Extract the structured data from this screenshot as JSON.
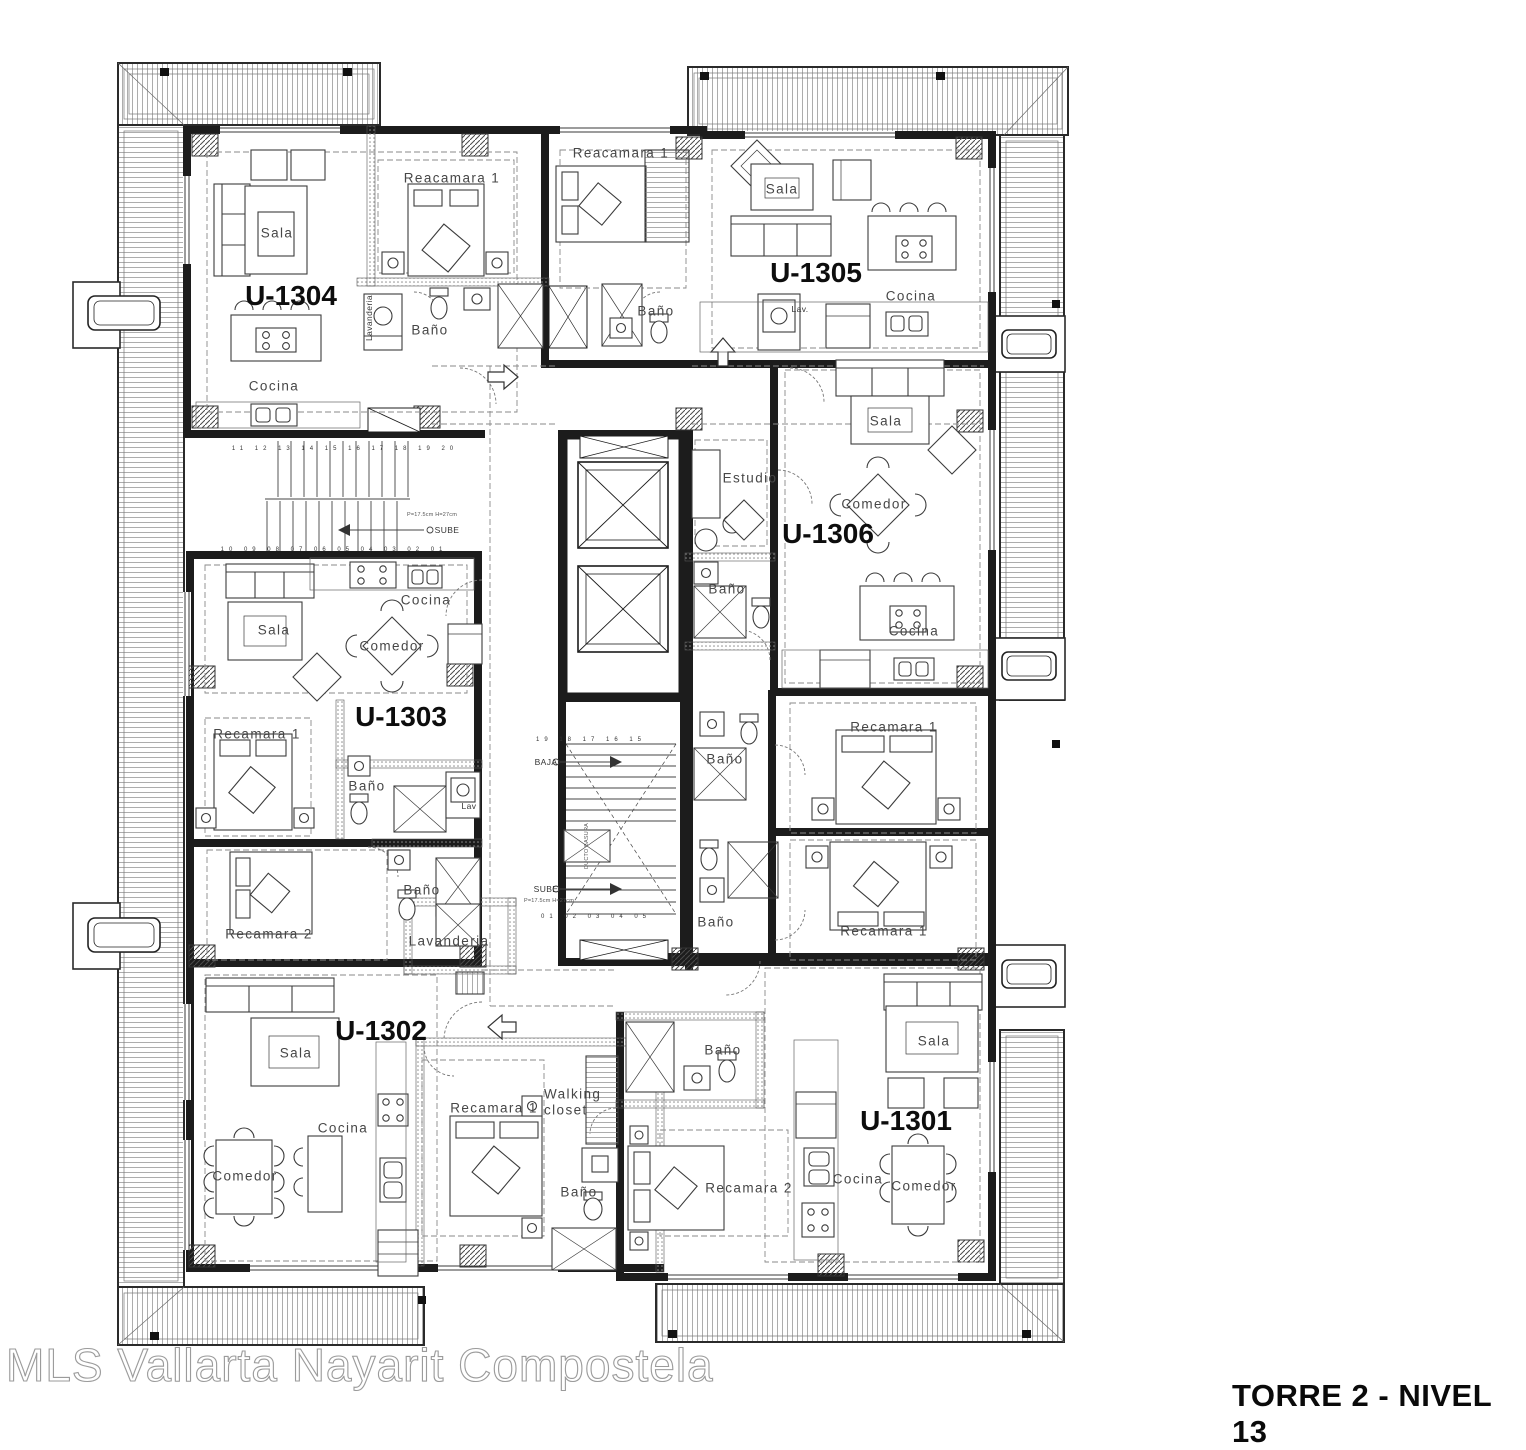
{
  "header": {
    "title": "TORRE 2 - NIVEL 13",
    "watermark": "MLS Vallarta Nayarit Compostela"
  },
  "units": [
    {
      "id": "U-1301",
      "rooms": [
        "Sala",
        "Comedor",
        "Cocina",
        "Recamara 1",
        "Recamara 2",
        "Baño"
      ]
    },
    {
      "id": "U-1302",
      "rooms": [
        "Sala",
        "Comedor",
        "Cocina",
        "Recamara 1",
        "Recamara 2",
        "Walking closet",
        "Baño",
        "Lavanderia"
      ]
    },
    {
      "id": "U-1303",
      "rooms": [
        "Sala",
        "Comedor",
        "Cocina",
        "Recamara 1",
        "Recamara 2",
        "Baño",
        "Lav"
      ]
    },
    {
      "id": "U-1304",
      "rooms": [
        "Sala",
        "Cocina",
        "Reacamara 1",
        "Baño",
        "Lavanderia"
      ]
    },
    {
      "id": "U-1305",
      "rooms": [
        "Sala",
        "Cocina",
        "Reacamara 1",
        "Baño",
        "Lav."
      ]
    },
    {
      "id": "U-1306",
      "rooms": [
        "Sala",
        "Comedor",
        "Cocina",
        "Estudio",
        "Recamara 1",
        "Baño"
      ]
    }
  ],
  "core": {
    "stair_labels": [
      "SUBE",
      "BAJA"
    ],
    "shaft_label": "DUCTO BASURA",
    "stair_note": "P=17.5cm  H=27cm"
  },
  "labels": [
    {
      "t": "U-1304",
      "x": 291,
      "y": 296,
      "c": "u",
      "n": "unit-label-u1304"
    },
    {
      "t": "U-1305",
      "x": 816,
      "y": 273,
      "c": "u",
      "n": "unit-label-u1305"
    },
    {
      "t": "U-1306",
      "x": 828,
      "y": 534,
      "c": "u",
      "n": "unit-label-u1306"
    },
    {
      "t": "U-1303",
      "x": 401,
      "y": 717,
      "c": "u",
      "n": "unit-label-u1303"
    },
    {
      "t": "U-1302",
      "x": 381,
      "y": 1031,
      "c": "u",
      "n": "unit-label-u1302"
    },
    {
      "t": "U-1301",
      "x": 906,
      "y": 1121,
      "c": "u",
      "n": "unit-label-u1301"
    },
    {
      "t": "Sala",
      "x": 277,
      "y": 233
    },
    {
      "t": "Reacamara 1",
      "x": 452,
      "y": 178
    },
    {
      "t": "Baño",
      "x": 430,
      "y": 330
    },
    {
      "t": "Lavanderia",
      "x": 369,
      "y": 318,
      "c": "rot xs"
    },
    {
      "t": "Cocina",
      "x": 274,
      "y": 386
    },
    {
      "t": "Reacamara 1",
      "x": 621,
      "y": 153
    },
    {
      "t": "Baño",
      "x": 656,
      "y": 311
    },
    {
      "t": "Sala",
      "x": 782,
      "y": 189
    },
    {
      "t": "Cocina",
      "x": 911,
      "y": 296
    },
    {
      "t": "Lav.",
      "x": 800,
      "y": 309,
      "c": "xs"
    },
    {
      "t": "Sala",
      "x": 886,
      "y": 421
    },
    {
      "t": "Comedor",
      "x": 874,
      "y": 504
    },
    {
      "t": "Estudio",
      "x": 750,
      "y": 478
    },
    {
      "t": "Baño",
      "x": 727,
      "y": 589
    },
    {
      "t": "Cocina",
      "x": 914,
      "y": 631
    },
    {
      "t": "Recamara 1",
      "x": 894,
      "y": 727
    },
    {
      "t": "Baño",
      "x": 725,
      "y": 759
    },
    {
      "t": "Recamara 1",
      "x": 884,
      "y": 931
    },
    {
      "t": "Baño",
      "x": 716,
      "y": 922
    },
    {
      "t": "Cocina",
      "x": 426,
      "y": 600
    },
    {
      "t": "Sala",
      "x": 274,
      "y": 630
    },
    {
      "t": "Comedor",
      "x": 392,
      "y": 646
    },
    {
      "t": "Recamara 1",
      "x": 257,
      "y": 734
    },
    {
      "t": "Baño",
      "x": 367,
      "y": 786
    },
    {
      "t": "Lav",
      "x": 469,
      "y": 806,
      "c": "xs"
    },
    {
      "t": "Recamara 2",
      "x": 269,
      "y": 934
    },
    {
      "t": "Baño",
      "x": 422,
      "y": 890
    },
    {
      "t": "Lavanderia",
      "x": 449,
      "y": 941
    },
    {
      "t": "Sala",
      "x": 296,
      "y": 1053
    },
    {
      "t": "Cocina",
      "x": 343,
      "y": 1128
    },
    {
      "t": "Comedor",
      "x": 245,
      "y": 1176
    },
    {
      "t": "Recamara 1",
      "x": 494,
      "y": 1108
    },
    {
      "t": "Walking closet",
      "x": 577,
      "y": 1102,
      "c": "wc"
    },
    {
      "t": "Baño",
      "x": 579,
      "y": 1192
    },
    {
      "t": "Baño",
      "x": 723,
      "y": 1050
    },
    {
      "t": "Recamara 2",
      "x": 749,
      "y": 1188
    },
    {
      "t": "Sala",
      "x": 934,
      "y": 1041
    },
    {
      "t": "Cocina",
      "x": 858,
      "y": 1179
    },
    {
      "t": "Comedor",
      "x": 924,
      "y": 1186
    },
    {
      "t": "SUBE",
      "x": 447,
      "y": 530,
      "c": "xs",
      "n": "stair-label"
    },
    {
      "t": "P=17.5cm  H=27cm",
      "x": 432,
      "y": 515,
      "c": "xxs",
      "n": "stair-note"
    },
    {
      "t": "BAJA",
      "x": 546,
      "y": 762,
      "c": "xs",
      "n": "stair-label"
    },
    {
      "t": "SUBE",
      "x": 546,
      "y": 889,
      "c": "xs",
      "n": "stair-label"
    },
    {
      "t": "P=17.5cm  H=27cm",
      "x": 549,
      "y": 901,
      "c": "xxs",
      "n": "stair-note"
    },
    {
      "t": "DUCTO BASURA",
      "x": 587,
      "y": 846,
      "c": "rot xxs",
      "n": "shaft-label"
    },
    {
      "t": "11 12 13 14 15 16 17 18 19 20",
      "x": 345,
      "y": 449,
      "c": "nums",
      "n": "tread-numbers"
    },
    {
      "t": "10 09 08 07 06 05 04 03 02 01",
      "x": 334,
      "y": 550,
      "c": "nums",
      "n": "tread-numbers"
    },
    {
      "t": "19 18 17 16 15",
      "x": 591,
      "y": 740,
      "c": "nums",
      "n": "tread-numbers"
    },
    {
      "t": "01 02 03 04 05",
      "x": 596,
      "y": 917,
      "c": "nums",
      "n": "tread-numbers"
    }
  ]
}
